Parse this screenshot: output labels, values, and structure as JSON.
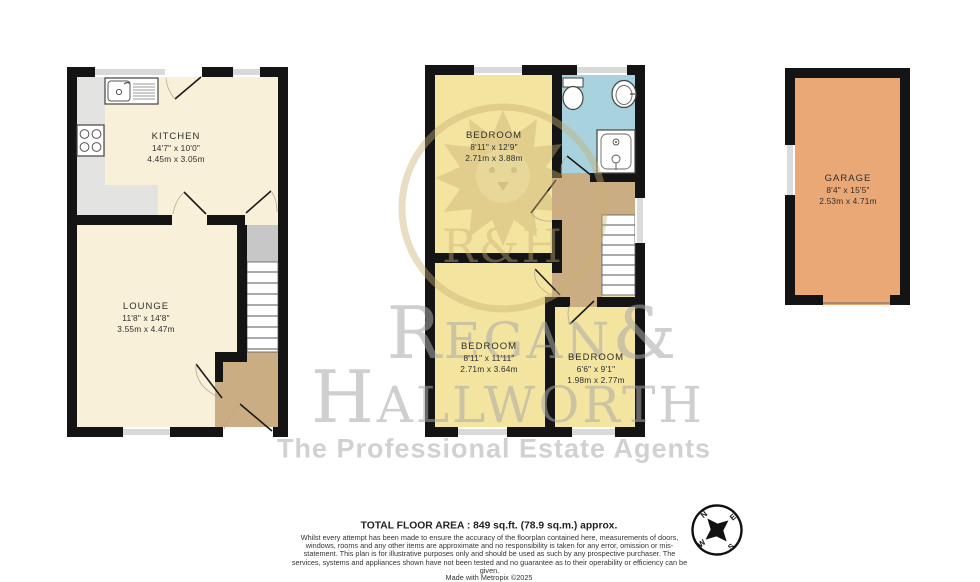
{
  "rooms": {
    "kitchen": {
      "name": "KITCHEN",
      "ft": "14'7\" x 10'0\"",
      "m": "4.45m x 3.05m"
    },
    "lounge": {
      "name": "LOUNGE",
      "ft": "11'8\" x 14'8\"",
      "m": "3.55m x 4.47m"
    },
    "bedroom1": {
      "name": "BEDROOM",
      "ft": "8'11\" x 12'9\"",
      "m": "2.71m x 3.88m"
    },
    "bedroom2": {
      "name": "BEDROOM",
      "ft": "8'11\" x 11'11\"",
      "m": "2.71m x 3.64m"
    },
    "bedroom3": {
      "name": "BEDROOM",
      "ft": "6'6\" x 9'1\"",
      "m": "1.98m x 2.77m"
    },
    "garage": {
      "name": "GARAGE",
      "ft": "8'4\" x 15'5\"",
      "m": "2.53m x 4.71m"
    }
  },
  "watermark": {
    "monogram": "R&H",
    "line1": "Regan&",
    "line2": "Hallworth",
    "tagline": "The Professional Estate Agents"
  },
  "footer": {
    "total_area": "TOTAL FLOOR AREA : 849 sq.ft. (78.9 sq.m.) approx.",
    "disclaimer": "Whilst every attempt has been made to ensure the accuracy of the floorplan contained here, measurements of doors, windows, rooms and any other items are approximate and no responsibility is taken for any error, omission or mis-statement. This plan is for illustrative purposes only and should be used as such by any prospective purchaser. The services, systems and appliances shown have not been tested and no guarantee as to their operability or efficiency can be given.",
    "credit": "Made with Metropix ©2025"
  },
  "compass": {
    "n": "N",
    "e": "E",
    "s": "S",
    "w": "W"
  },
  "colors": {
    "wall": "#141414",
    "floor_cream": "#f8f0d8",
    "floor_yellow": "#f3e4a0",
    "floor_blue": "#a8d2de",
    "floor_tan": "#cbad84",
    "counter_gray": "#e3e3e2",
    "cupboard_gray": "#c7c7c7",
    "garage_orange": "#eba877",
    "watermark_gold": "#c9b272",
    "watermark_gray": "#a8a8a8"
  }
}
